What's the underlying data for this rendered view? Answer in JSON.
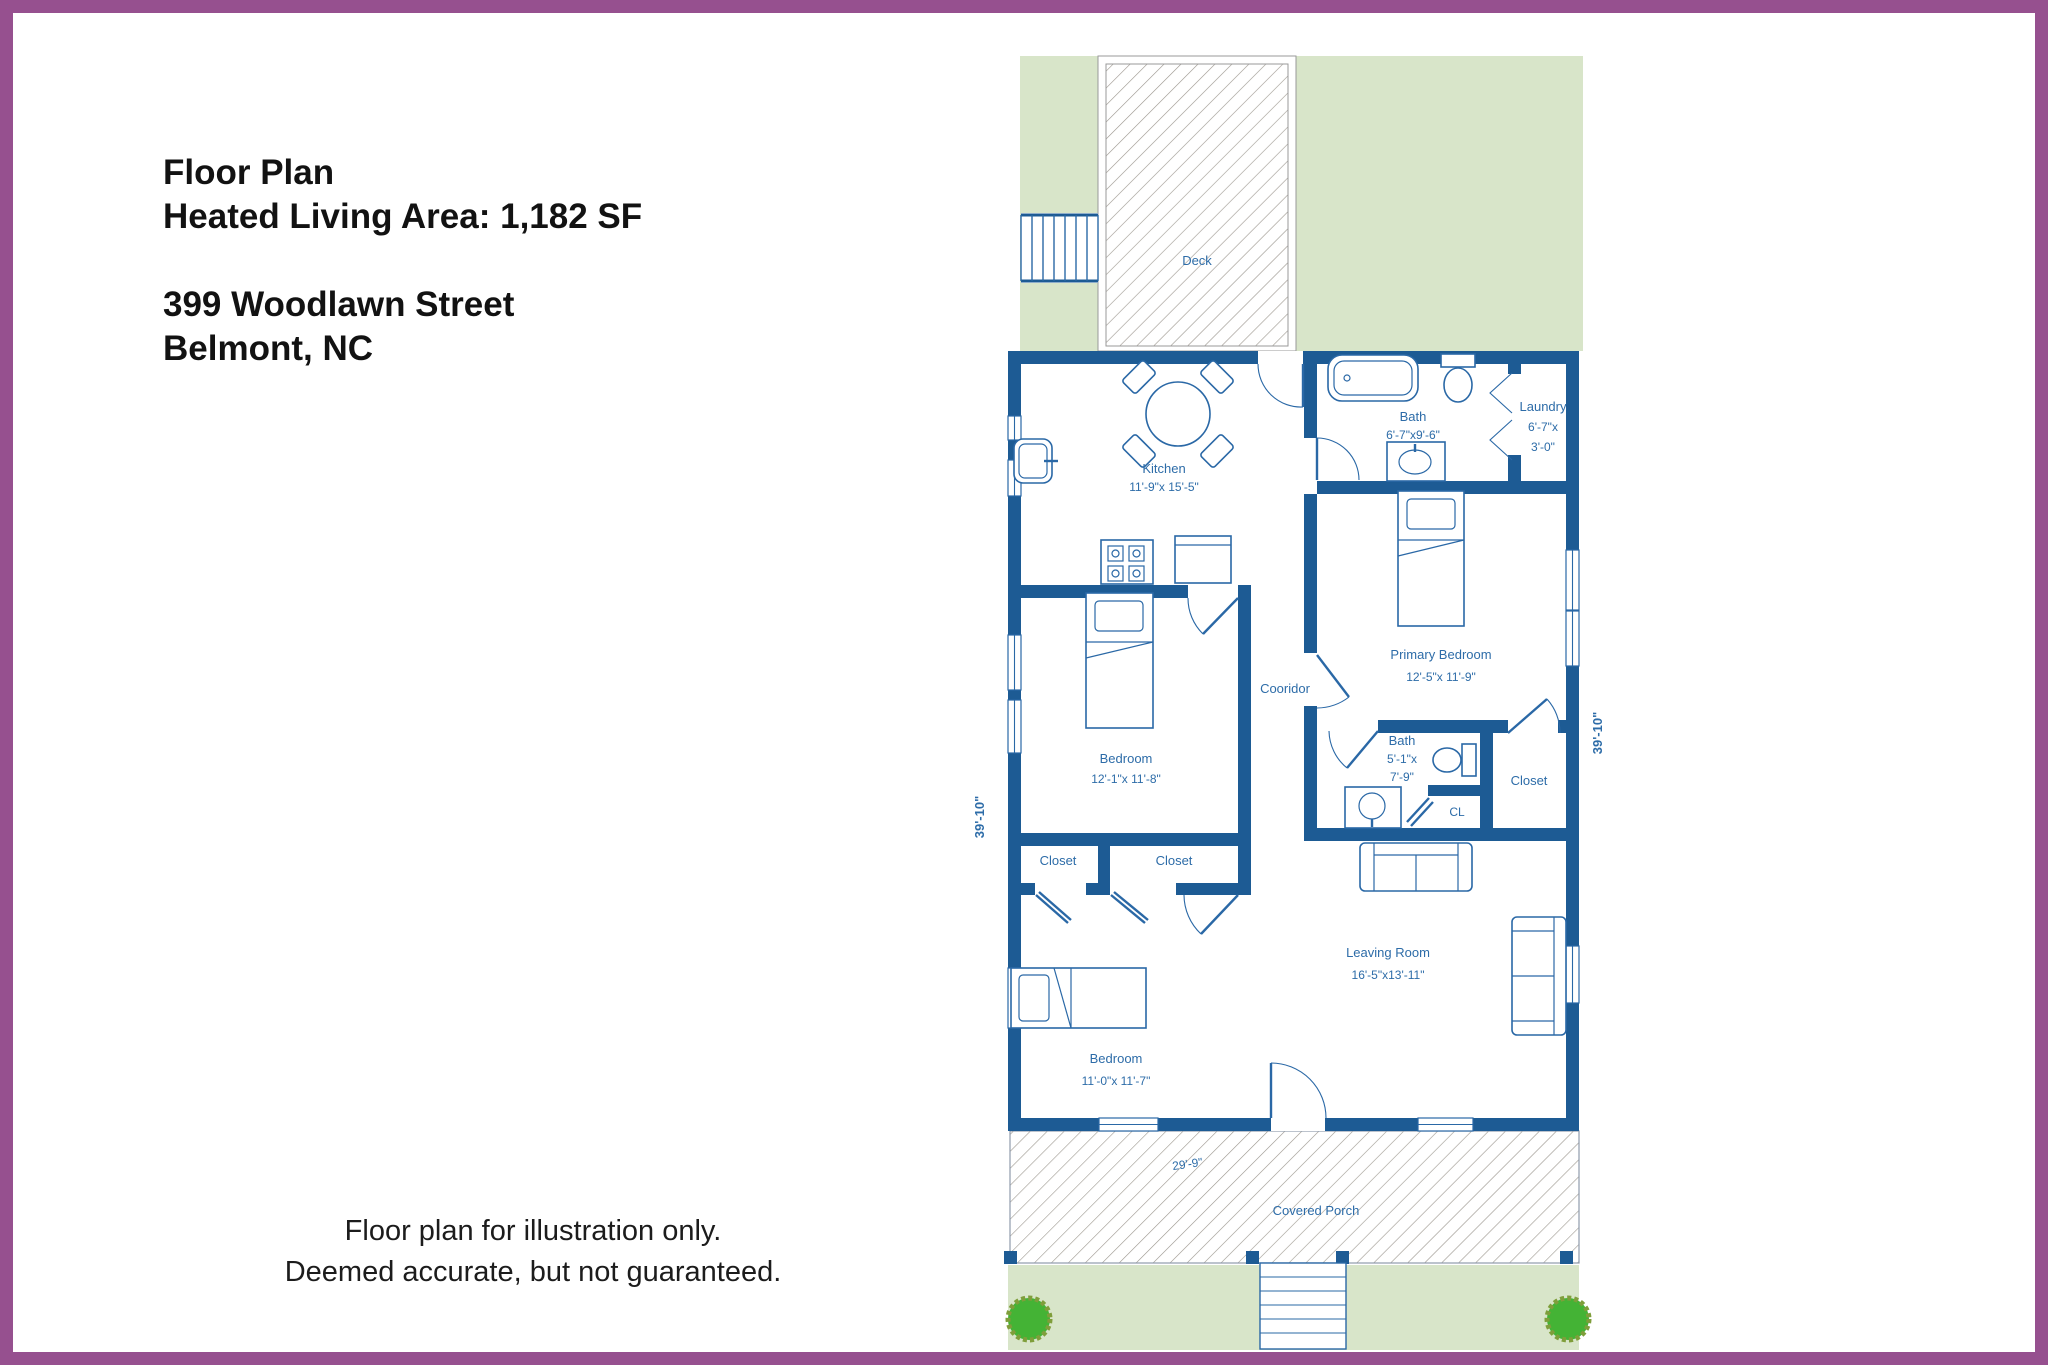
{
  "header": {
    "title": "Floor Plan",
    "subtitle": "Heated Living Area: 1,182 SF",
    "address_line1": "399 Woodlawn Street",
    "address_line2": "Belmont, NC"
  },
  "footer": {
    "disclaimer_line1": "Floor plan for illustration only.",
    "disclaimer_line2": "Deemed accurate, but not guaranteed."
  },
  "plan": {
    "deck": {
      "label": "Deck"
    },
    "kitchen": {
      "name": "Kitchen",
      "dims": "11'-9\"x 15'-5\""
    },
    "bath_main": {
      "name": "Bath",
      "dims": "6'-7\"x9'-6\""
    },
    "laundry": {
      "name": "Laundry",
      "dims_line1": "6'-7\"x",
      "dims_line2": "3'-0\""
    },
    "primary_bedroom": {
      "name": "Primary Bedroom",
      "dims": "12'-5\"x 11'-9\""
    },
    "corridor": {
      "label": "Cooridor"
    },
    "bedroom_middle": {
      "name": "Bedroom",
      "dims": "12'-1\"x 11'-8\""
    },
    "bath_small": {
      "name": "Bath",
      "dims_line1": "5'-1\"x",
      "dims_line2": "7'-9\""
    },
    "closet_small": {
      "label": "CL"
    },
    "closet_primary": {
      "label": "Closet"
    },
    "closet_left": {
      "label": "Closet"
    },
    "closet_right": {
      "label": "Closet"
    },
    "bedroom_front": {
      "name": "Bedroom",
      "dims": "11'-0\"x 11'-7\""
    },
    "living_room": {
      "name": "Leaving Room",
      "dims": "16'-5\"x13'-11\""
    },
    "covered_porch": {
      "label": "Covered Porch",
      "width_dim": "29'-9\""
    },
    "side_dim_left": "39'-10\"",
    "side_dim_right": "39'-10\"",
    "colors": {
      "wall": "#1d5b94",
      "label_text": "#2d6ca8",
      "lawn": "#d8e5c9",
      "hatch_line": "#9b968e",
      "bush": "#44b335",
      "frame_border": "#96508f"
    }
  }
}
